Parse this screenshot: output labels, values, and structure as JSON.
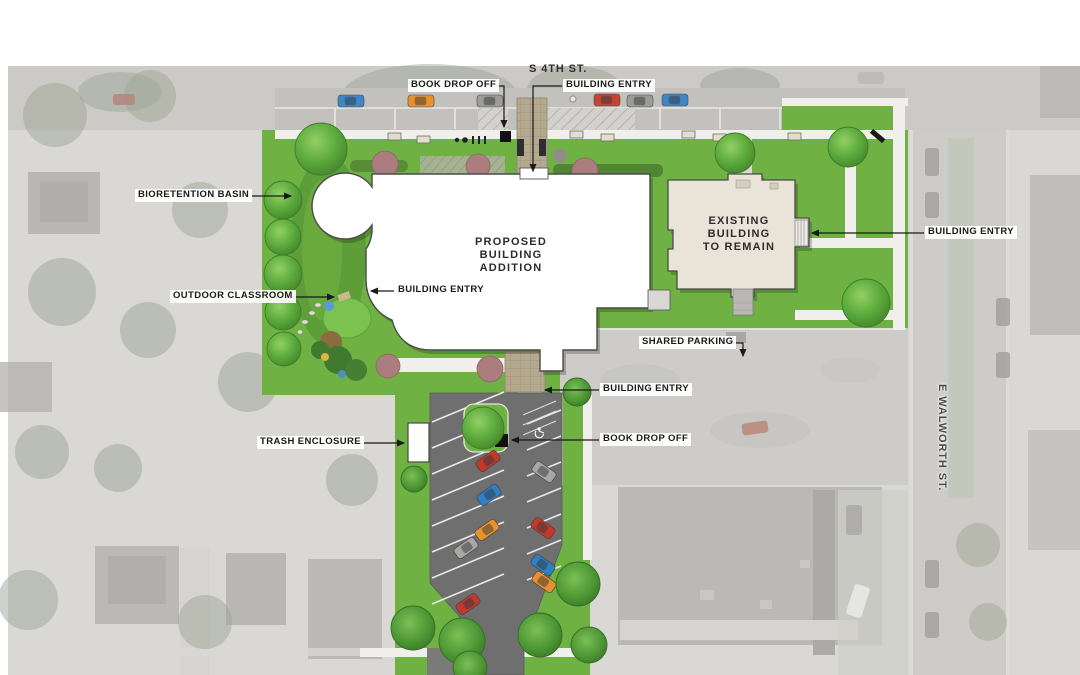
{
  "streets": {
    "top": "S 4TH ST.",
    "right": "E WALWORTH ST."
  },
  "buildings": {
    "proposed": "PROPOSED\nBUILDING\nADDITION",
    "existing": "EXISTING\nBUILDING\nTO REMAIN"
  },
  "callouts": {
    "book_drop_off_top": "BOOK DROP OFF",
    "building_entry_top": "BUILDING ENTRY",
    "bioretention_basin": "BIORETENTION BASIN",
    "outdoor_classroom": "OUTDOOR CLASSROOM",
    "building_entry_west": "BUILDING ENTRY",
    "building_entry_east": "BUILDING ENTRY",
    "shared_parking": "SHARED PARKING",
    "building_entry_south": "BUILDING ENTRY",
    "trash_enclosure": "TRASH ENCLOSURE",
    "book_drop_off_south": "BOOK DROP OFF"
  },
  "colors": {
    "lawn": "#6FB243",
    "lawn_dark": "#5C9A37",
    "tree_edge": "#3C7D2A",
    "street": "#C2C1BD",
    "shared_parking": "#CDCCC8",
    "asphalt": "#6F6F6F",
    "paver": "#B4A98E",
    "proposed_building": "#FFFFFF",
    "existing_building": "#E9E4D7",
    "shrub": "#AB7D7E",
    "label_text": "#1A1A1A",
    "label_bg": "#FFFFFF"
  }
}
